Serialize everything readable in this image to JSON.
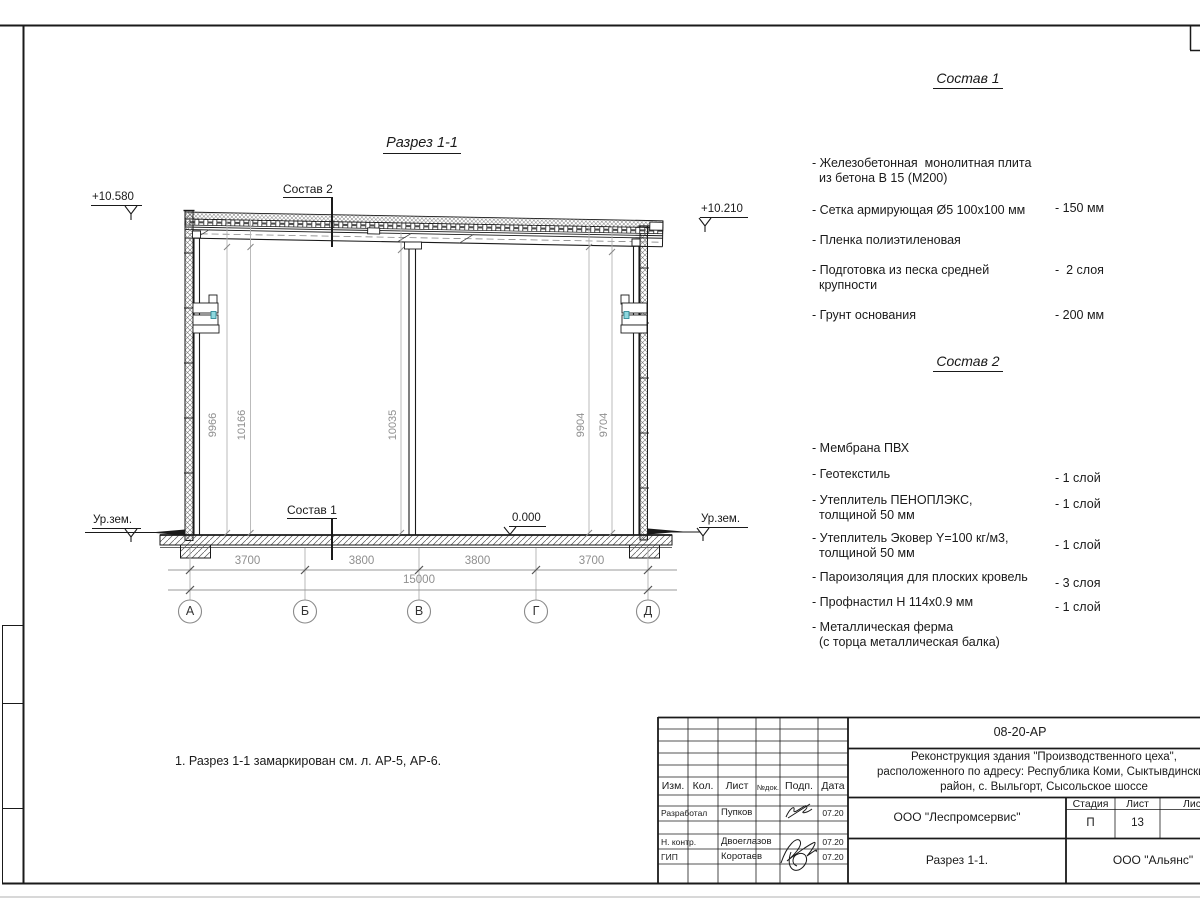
{
  "section": {
    "title": "Разрез 1-1",
    "sostav1_label": "Состав 1",
    "sostav2_label": "Состав 2",
    "elev_left": "+10.580",
    "elev_right": "+10.210",
    "elev_zero": "0.000",
    "ground_left": "Ур.зем.",
    "ground_right": "Ур.зем.",
    "dims_bottom": [
      "3700",
      "3800",
      "3800",
      "3700"
    ],
    "dim_total": "15000",
    "dims_vertical": [
      "9966",
      "10166",
      "10035",
      "9904",
      "9704"
    ],
    "axes": [
      "А",
      "Б",
      "В",
      "Г",
      "Д"
    ]
  },
  "note": "1. Разрез 1-1 замаркирован см. л. АР-5, АР-6.",
  "sostav1": {
    "title": "Состав 1",
    "items": [
      {
        "line1": "- Железобетонная  монолитная плита",
        "line2": "из бетона В 15 (М200)",
        "value": "- 150 мм"
      },
      {
        "line1": "- Сетка армирующая Ø5 100x100 мм",
        "value": ""
      },
      {
        "line1": "- Пленка полиэтиленовая",
        "value": "-  2 слоя"
      },
      {
        "line1": "- Подготовка из песка средней",
        "line2": "крупности",
        "value": "- 200 мм"
      },
      {
        "line1": "- Грунт основания",
        "value": ""
      }
    ]
  },
  "sostav2": {
    "title": "Состав 2",
    "items": [
      {
        "line1": "- Мембрана ПВХ",
        "value": "- 1 слой"
      },
      {
        "line1": "- Геотекстиль",
        "value": "- 1 слой"
      },
      {
        "line1": "- Утеплитель ПЕНОПЛЭКС,",
        "line2": "толщиной 50 мм",
        "value": "- 1 слой"
      },
      {
        "line1": "- Утеплитель Эковер Y=100 кг/м3,",
        "line2": "толщиной 50 мм",
        "value": "- 3 слоя"
      },
      {
        "line1": "- Пароизоляция для плоских кровель",
        "value": "- 1 слой"
      },
      {
        "line1": "- Профнастил Н 114x0.9 мм",
        "value": ""
      },
      {
        "line1": "- Металлическая ферма",
        "line2": "(с торца металлическая балка)",
        "value": ""
      }
    ]
  },
  "titleblock": {
    "doc_number": "08-20-АР",
    "project_line1": "Реконструкция здания \"Производственного цеха\",",
    "project_line2": "расположенного по адресу: Республика Коми, Сыктывдинский",
    "project_line3": "район, с. Выльгорт, Сысольское шоссе",
    "col_izm": "Изм.",
    "col_kol": "Кол.",
    "col_list": "Лист",
    "col_doc": "№док.",
    "col_podp": "Подп.",
    "col_data": "Дата",
    "row1_role": "Разработал",
    "row1_name": "Пупков",
    "row1_date": "07.20",
    "row2_role": "Н. контр.",
    "row2_name": "Двоеглазов",
    "row2_date": "07.20",
    "row3_role": "ГИП",
    "row3_name": "Коротаев",
    "row3_date": "07.20",
    "org": "ООО \"Леспромсервис\"",
    "sheet_name": "Разрез 1-1.",
    "contractor": "ООО \"Альянс\"",
    "stage_label": "Стадия",
    "list_label": "Лист",
    "listov_label": "Листов",
    "stage": "П",
    "sheet_no": "13"
  },
  "colors": {
    "line": "#1a1a1a",
    "dim_gray": "#8f8f8f",
    "accent_cyan": "#8fd8de"
  }
}
